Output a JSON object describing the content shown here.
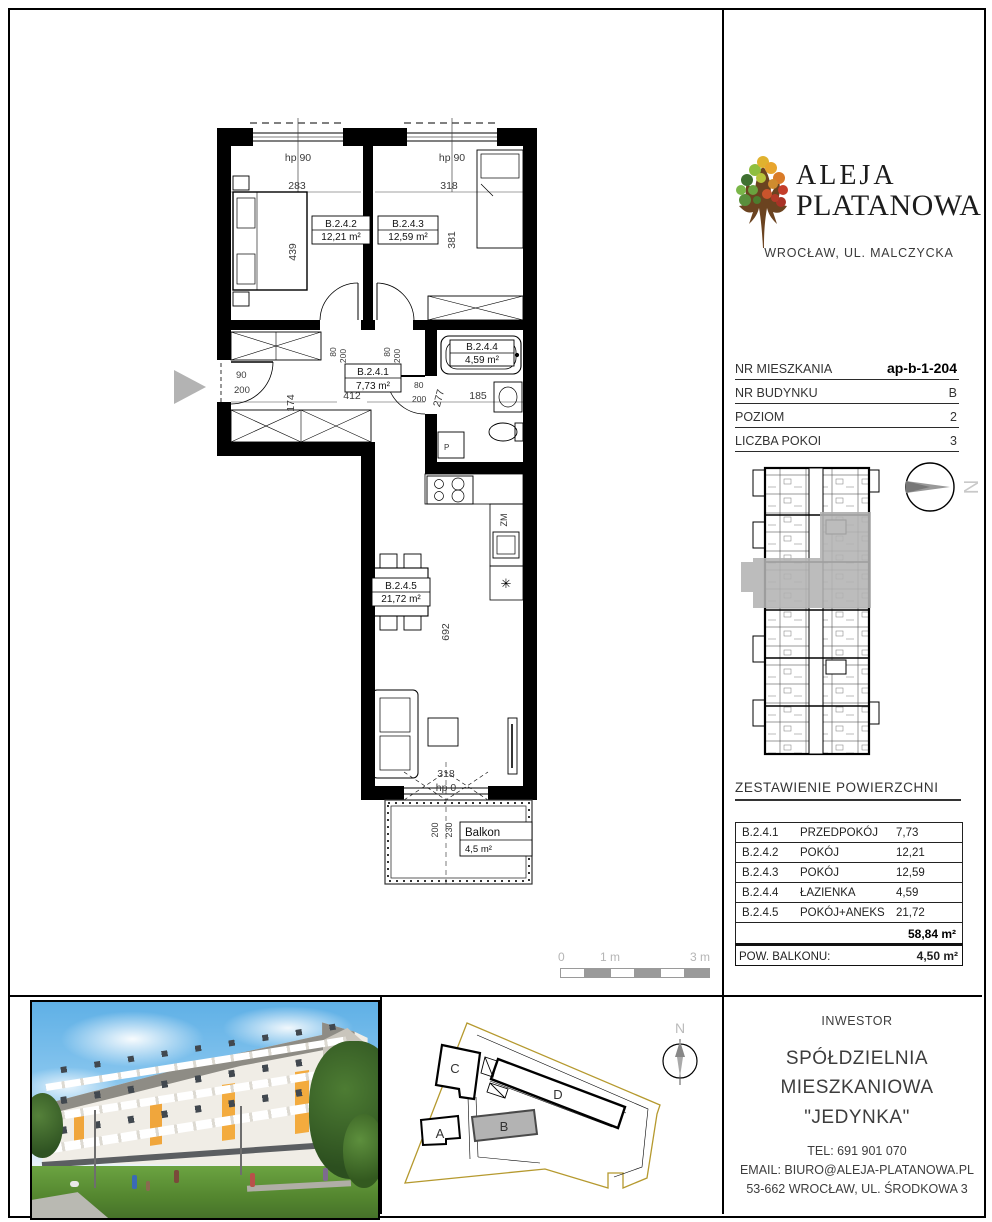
{
  "logo": {
    "title_line1": "ALEJA",
    "title_line2": "PLATANOWA",
    "subtitle": "WROCŁAW, UL. MALCZYCKA"
  },
  "info": {
    "rows": [
      {
        "label": "NR MIESZKANIA",
        "value": "ap-b-1-204"
      },
      {
        "label": "NR BUDYNKU",
        "value": "B"
      },
      {
        "label": "POZIOM",
        "value": "2"
      },
      {
        "label": "LICZBA POKOI",
        "value": "3"
      }
    ]
  },
  "areas": {
    "heading": "ZESTAWIENIE POWIERZCHNI",
    "rows": [
      {
        "code": "B.2.4.1",
        "name": "PRZEDPOKÓJ",
        "value": "7,73"
      },
      {
        "code": "B.2.4.2",
        "name": "POKÓJ",
        "value": "12,21"
      },
      {
        "code": "B.2.4.3",
        "name": "POKÓJ",
        "value": "12,59"
      },
      {
        "code": "B.2.4.4",
        "name": "ŁAZIENKA",
        "value": "4,59"
      },
      {
        "code": "B.2.4.5",
        "name": "POKÓJ+ANEKS",
        "value": "21,72"
      }
    ],
    "total": "58,84 m²",
    "balcony_label": "POW. BALKONU:",
    "balcony_value": "4,50 m²"
  },
  "investor": {
    "heading": "INWESTOR",
    "name_line1": "SPÓŁDZIELNIA",
    "name_line2": "MIESZKANIOWA \"JEDYNKA\"",
    "tel": "TEL:  691 901 070",
    "email": "EMAIL: BIURO@ALEJA-PLATANOWA.PL",
    "address": "53-662 WROCŁAW, UL. ŚRODKOWA 3"
  },
  "plan": {
    "rooms": [
      {
        "code": "B.2.4.1",
        "area": "7,73 m²"
      },
      {
        "code": "B.2.4.2",
        "area": "12,21 m²"
      },
      {
        "code": "B.2.4.3",
        "area": "12,59 m²"
      },
      {
        "code": "B.2.4.4",
        "area": "4,59 m²"
      },
      {
        "code": "B.2.4.5",
        "area": "21,72 m²"
      }
    ],
    "balcony": {
      "name": "Balkon",
      "area": "4,5 m²"
    },
    "dims": {
      "room2_w": "283",
      "room3_w": "318",
      "room2_h": "439",
      "room3_h": "381",
      "hall_w": "412",
      "hall_h": "174",
      "bath_w": "185",
      "bath_h": "277",
      "living_h": "692",
      "balcony_door_w": "318",
      "balcony_d1": "200",
      "balcony_d2": "230",
      "entry_w": "90",
      "entry_h": "200",
      "door_w": "80",
      "door_h": "200",
      "hp90": "hp 90",
      "hp0": "hp 0"
    },
    "appliances": {
      "washing_machine": "P",
      "dishwasher": "ZM",
      "fridge": "✳"
    }
  },
  "scale_bar": {
    "labels": [
      "0",
      "1 m",
      "3 m"
    ]
  },
  "site_plan": {
    "buildings": [
      "A",
      "B",
      "C",
      "D"
    ],
    "north": "N"
  },
  "key_plan": {
    "north": "N"
  }
}
